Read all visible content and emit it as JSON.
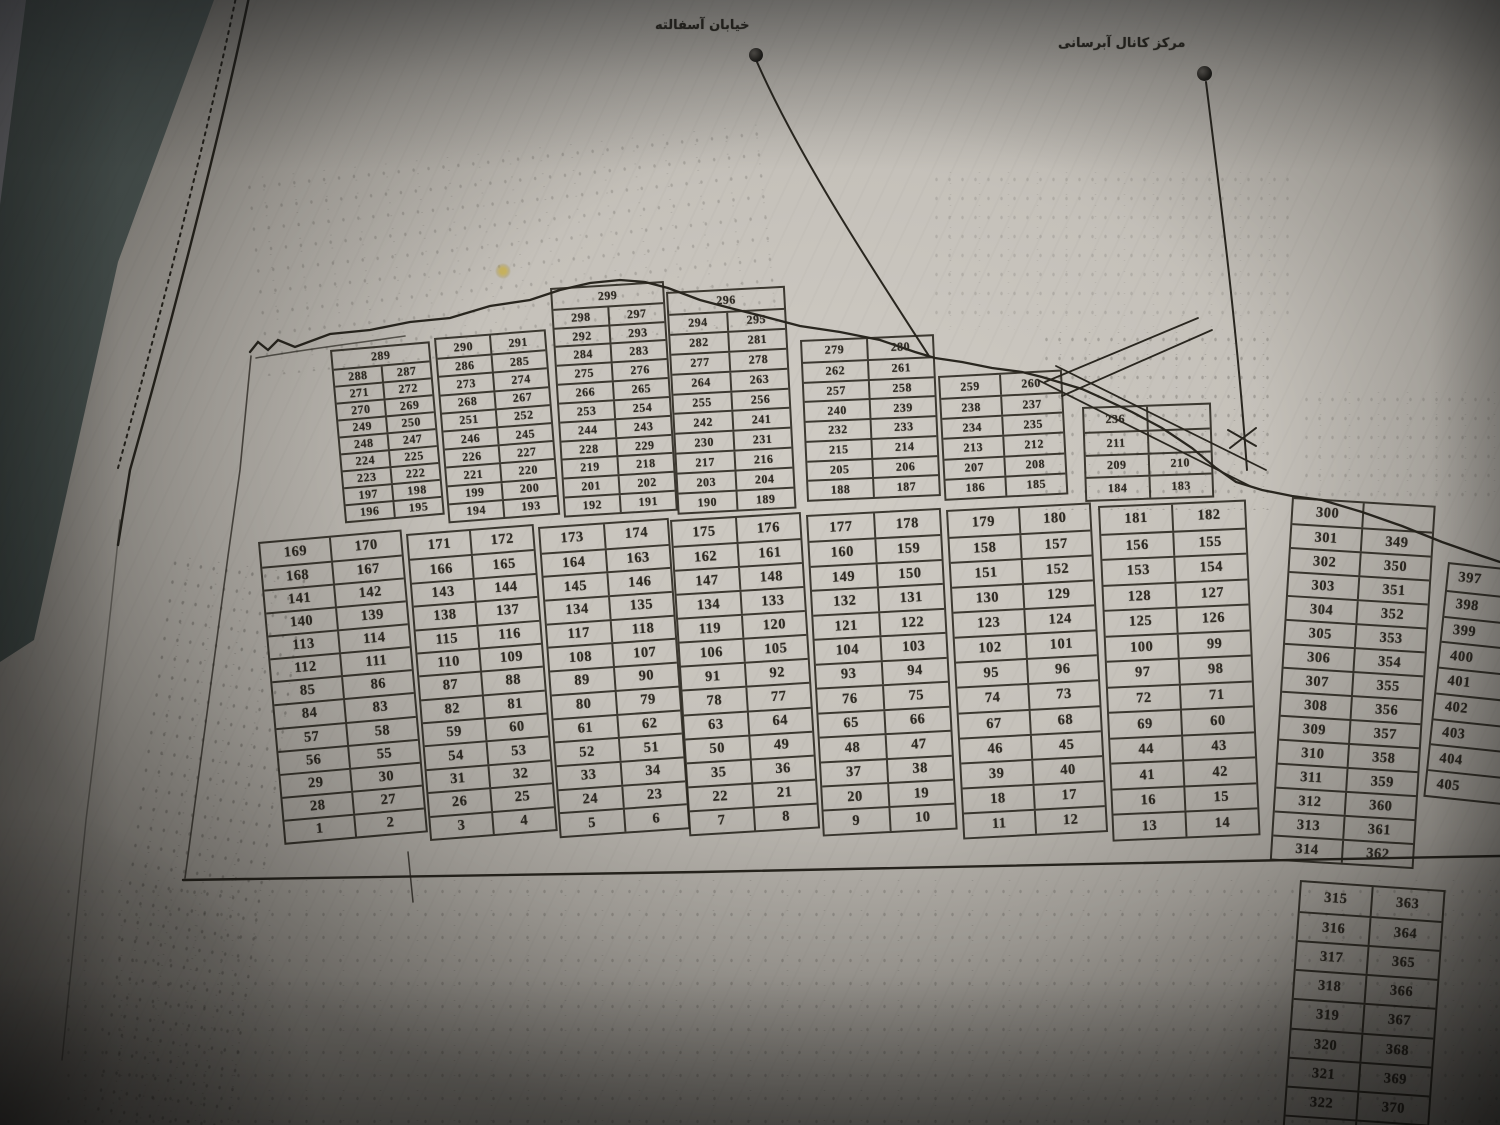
{
  "labels": {
    "asphalt_street": "خیابان آسفالته",
    "water_canal": "مرکز کانال آبرسانی"
  },
  "colors": {
    "paper": "#c5c1ba",
    "ink": "#2f2b24",
    "wall_dark": "#4d5855",
    "wall_light": "#96969c"
  },
  "blocks": [
    {
      "id": "ua",
      "rows": [
        [
          "289"
        ],
        [
          "288",
          "287"
        ],
        [
          "271",
          "272"
        ],
        [
          "270",
          "269"
        ],
        [
          "249",
          "250"
        ],
        [
          "248",
          "247"
        ],
        [
          "224",
          "225"
        ],
        [
          "223",
          "222"
        ],
        [
          "197",
          "198"
        ],
        [
          "196",
          "195"
        ]
      ]
    },
    {
      "id": "ub",
      "rows": [
        [
          "290",
          "291"
        ],
        [
          "286",
          "285"
        ],
        [
          "273",
          "274"
        ],
        [
          "268",
          "267"
        ],
        [
          "251",
          "252"
        ],
        [
          "246",
          "245"
        ],
        [
          "226",
          "227"
        ],
        [
          "221",
          "220"
        ],
        [
          "199",
          "200"
        ],
        [
          "194",
          "193"
        ]
      ]
    },
    {
      "id": "uc",
      "rows": [
        [
          "299"
        ],
        [
          "298",
          "297"
        ],
        [
          "292",
          "293"
        ],
        [
          "284",
          "283"
        ],
        [
          "275",
          "276"
        ],
        [
          "266",
          "265"
        ],
        [
          "253",
          "254"
        ],
        [
          "244",
          "243"
        ],
        [
          "228",
          "229"
        ],
        [
          "219",
          "218"
        ],
        [
          "201",
          "202"
        ],
        [
          "192",
          "191"
        ]
      ]
    },
    {
      "id": "ud",
      "rows": [
        [
          "296"
        ],
        [
          "294",
          "295"
        ],
        [
          "282",
          "281"
        ],
        [
          "277",
          "278"
        ],
        [
          "264",
          "263"
        ],
        [
          "255",
          "256"
        ],
        [
          "242",
          "241"
        ],
        [
          "230",
          "231"
        ],
        [
          "217",
          "216"
        ],
        [
          "203",
          "204"
        ],
        [
          "190",
          "189"
        ]
      ]
    },
    {
      "id": "ue",
      "rows": [
        [
          "279",
          "280"
        ],
        [
          "262",
          "261"
        ],
        [
          "257",
          "258"
        ],
        [
          "240",
          "239"
        ],
        [
          "232",
          "233"
        ],
        [
          "215",
          "214"
        ],
        [
          "205",
          "206"
        ],
        [
          "188",
          "187"
        ]
      ]
    },
    {
      "id": "uf",
      "rows": [
        [
          "259",
          "260"
        ],
        [
          "238",
          "237"
        ],
        [
          "234",
          "235"
        ],
        [
          "213",
          "212"
        ],
        [
          "207",
          "208"
        ],
        [
          "186",
          "185"
        ]
      ]
    },
    {
      "id": "ug",
      "rows": [
        [
          "236",
          null
        ],
        [
          "211",
          null
        ],
        [
          "209",
          "210"
        ],
        [
          "184",
          "183"
        ]
      ]
    },
    {
      "id": "m1",
      "rows": [
        [
          "169",
          "170"
        ],
        [
          "168",
          "167"
        ],
        [
          "141",
          "142"
        ],
        [
          "140",
          "139"
        ],
        [
          "113",
          "114"
        ],
        [
          "112",
          "111"
        ],
        [
          "85",
          "86"
        ],
        [
          "84",
          "83"
        ],
        [
          "57",
          "58"
        ],
        [
          "56",
          "55"
        ],
        [
          "29",
          "30"
        ],
        [
          "28",
          "27"
        ],
        [
          "1",
          "2"
        ]
      ]
    },
    {
      "id": "m2",
      "rows": [
        [
          "171",
          "172"
        ],
        [
          "166",
          "165"
        ],
        [
          "143",
          "144"
        ],
        [
          "138",
          "137"
        ],
        [
          "115",
          "116"
        ],
        [
          "110",
          "109"
        ],
        [
          "87",
          "88"
        ],
        [
          "82",
          "81"
        ],
        [
          "59",
          "60"
        ],
        [
          "54",
          "53"
        ],
        [
          "31",
          "32"
        ],
        [
          "26",
          "25"
        ],
        [
          "3",
          "4"
        ]
      ]
    },
    {
      "id": "m3",
      "rows": [
        [
          "173",
          "174"
        ],
        [
          "164",
          "163"
        ],
        [
          "145",
          "146"
        ],
        [
          "134",
          "135"
        ],
        [
          "117",
          "118"
        ],
        [
          "108",
          "107"
        ],
        [
          "89",
          "90"
        ],
        [
          "80",
          "79"
        ],
        [
          "61",
          "62"
        ],
        [
          "52",
          "51"
        ],
        [
          "33",
          "34"
        ],
        [
          "24",
          "23"
        ],
        [
          "5",
          "6"
        ]
      ]
    },
    {
      "id": "m4",
      "rows": [
        [
          "175",
          "176"
        ],
        [
          "162",
          "161"
        ],
        [
          "147",
          "148"
        ],
        [
          "134",
          "133"
        ],
        [
          "119",
          "120"
        ],
        [
          "106",
          "105"
        ],
        [
          "91",
          "92"
        ],
        [
          "78",
          "77"
        ],
        [
          "63",
          "64"
        ],
        [
          "50",
          "49"
        ],
        [
          "35",
          "36"
        ],
        [
          "22",
          "21"
        ],
        [
          "7",
          "8"
        ]
      ]
    },
    {
      "id": "m5",
      "rows": [
        [
          "177",
          "178"
        ],
        [
          "160",
          "159"
        ],
        [
          "149",
          "150"
        ],
        [
          "132",
          "131"
        ],
        [
          "121",
          "122"
        ],
        [
          "104",
          "103"
        ],
        [
          "93",
          "94"
        ],
        [
          "76",
          "75"
        ],
        [
          "65",
          "66"
        ],
        [
          "48",
          "47"
        ],
        [
          "37",
          "38"
        ],
        [
          "20",
          "19"
        ],
        [
          "9",
          "10"
        ]
      ]
    },
    {
      "id": "m6",
      "rows": [
        [
          "179",
          "180"
        ],
        [
          "158",
          "157"
        ],
        [
          "151",
          "152"
        ],
        [
          "130",
          "129"
        ],
        [
          "123",
          "124"
        ],
        [
          "102",
          "101"
        ],
        [
          "95",
          "96"
        ],
        [
          "74",
          "73"
        ],
        [
          "67",
          "68"
        ],
        [
          "46",
          "45"
        ],
        [
          "39",
          "40"
        ],
        [
          "18",
          "17"
        ],
        [
          "11",
          "12"
        ]
      ]
    },
    {
      "id": "m7",
      "rows": [
        [
          "181",
          "182"
        ],
        [
          "156",
          "155"
        ],
        [
          "153",
          "154"
        ],
        [
          "128",
          "127"
        ],
        [
          "125",
          "126"
        ],
        [
          "100",
          "99"
        ],
        [
          "97",
          "98"
        ],
        [
          "72",
          "71"
        ],
        [
          "69",
          "60"
        ],
        [
          "44",
          "43"
        ],
        [
          "41",
          "42"
        ],
        [
          "16",
          "15"
        ],
        [
          "13",
          "14"
        ]
      ]
    },
    {
      "id": "r8",
      "rows": [
        [
          "300",
          null
        ],
        [
          "301",
          "349"
        ],
        [
          "302",
          "350"
        ],
        [
          "303",
          "351"
        ],
        [
          "304",
          "352"
        ],
        [
          "305",
          "353"
        ],
        [
          "306",
          "354"
        ],
        [
          "307",
          "355"
        ],
        [
          "308",
          "356"
        ],
        [
          "309",
          "357"
        ],
        [
          "310",
          "358"
        ],
        [
          "311",
          "359"
        ],
        [
          "312",
          "360"
        ],
        [
          "313",
          "361"
        ],
        [
          "314",
          "362"
        ]
      ]
    },
    {
      "id": "r9",
      "rows": [
        [
          "315",
          "363"
        ],
        [
          "316",
          "364"
        ],
        [
          "317",
          "365"
        ],
        [
          "318",
          "366"
        ],
        [
          "319",
          "367"
        ],
        [
          "320",
          "368"
        ],
        [
          "321",
          "369"
        ],
        [
          "322",
          "370"
        ],
        [
          "323",
          "371"
        ]
      ]
    },
    {
      "id": "r10",
      "rows": [
        [
          "397"
        ],
        [
          "398"
        ],
        [
          "399"
        ],
        [
          "400"
        ],
        [
          "401"
        ],
        [
          "402"
        ],
        [
          "403"
        ],
        [
          "404"
        ],
        [
          "405"
        ]
      ]
    }
  ]
}
